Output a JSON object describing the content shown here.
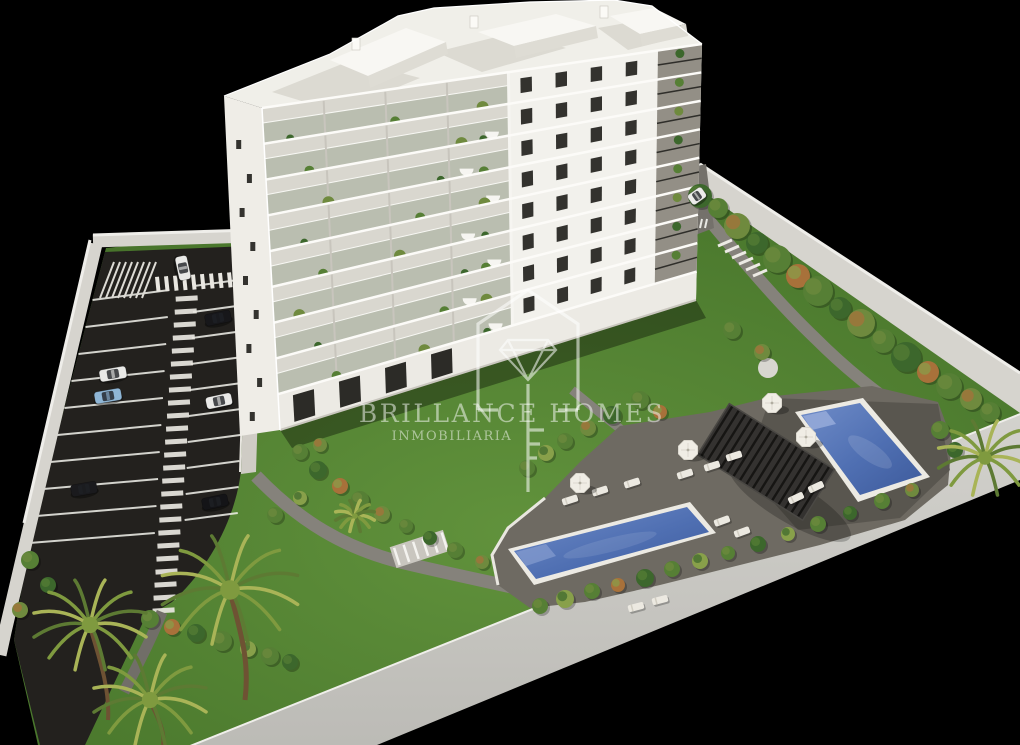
{
  "scene": {
    "type": "3d-architectural-render-aerial-view",
    "background_color": "#000000",
    "description": "Aerial 3D render of a residential development: a white 9-storey apartment block with plant-lined glass balconies, a private parking lot with painted stalls, zebra walkway and pedestrian crossings, landscaped gardens with palm trees, two blue swimming pools, a dark louvred pergola with sun loungers and white parasols, all enclosed by a white perimeter wall on a black background"
  },
  "watermark": {
    "brand": "BRILLANCE HOMES",
    "tagline": "INMOBILIARIA",
    "logo_icon": "house-diamond-key-icon",
    "color": "#ffffff"
  },
  "palette": {
    "background": "#000000",
    "grass_light": "#61923c",
    "grass_dark": "#3e6625",
    "asphalt": "#23211e",
    "perimeter_wall": "#d6d4ce",
    "wall_highlight": "#efeeea",
    "boundary_band": "#c9c8c3",
    "building_white": "#f2f1ec",
    "building_side": "#efede7",
    "balcony_recess": "#d9d7cf",
    "pool_water_light": "#5f7fc0",
    "pool_water_dark": "#44619f",
    "pool_rim": "#eceae3",
    "sun_deck": "#6e6a62",
    "sun_deck_dark": "#56524c",
    "pergola": "#343230",
    "garden_path": "#85827b",
    "lounger_white": "#ece9e1",
    "palm_frond": "#a9b457"
  },
  "objects": {
    "building": {
      "name": "apartment-building",
      "floors": 9,
      "facade": "white with glass balconies, plants and white dome awnings"
    },
    "pools": [
      {
        "name": "main-pool"
      },
      {
        "name": "lap-pool"
      }
    ],
    "pergola_count": 1,
    "parasol_count": 4,
    "lounger_count": 12,
    "palm_count": 4,
    "parking": {
      "stall_rows": 2,
      "features": [
        "zebra walkway",
        "pedestrian crossing",
        "hatched zone"
      ]
    },
    "cars": [
      {
        "color": "#e9e9e7",
        "x": 183,
        "y": 268,
        "angle": 78,
        "len": 24,
        "label": "white car in entrance lane"
      },
      {
        "color": "#17171a",
        "x": 218,
        "y": 318,
        "angle": -12,
        "len": 26,
        "label": "black car"
      },
      {
        "color": "#e9e9e7",
        "x": 113,
        "y": 374,
        "angle": -10,
        "len": 27,
        "label": "white suv"
      },
      {
        "color": "#8fb6d6",
        "x": 108,
        "y": 396,
        "angle": -10,
        "len": 27,
        "label": "blue car"
      },
      {
        "color": "#e9e9e7",
        "x": 219,
        "y": 401,
        "angle": -12,
        "len": 26,
        "label": "white car"
      },
      {
        "color": "#1a1a1d",
        "x": 84,
        "y": 489,
        "angle": -10,
        "len": 26,
        "label": "black car"
      },
      {
        "color": "#141417",
        "x": 215,
        "y": 502,
        "angle": -12,
        "len": 26,
        "label": "black car"
      },
      {
        "color": "#ececea",
        "x": 697,
        "y": 196,
        "angle": -35,
        "len": 17,
        "label": "white car at side entrance"
      }
    ]
  }
}
